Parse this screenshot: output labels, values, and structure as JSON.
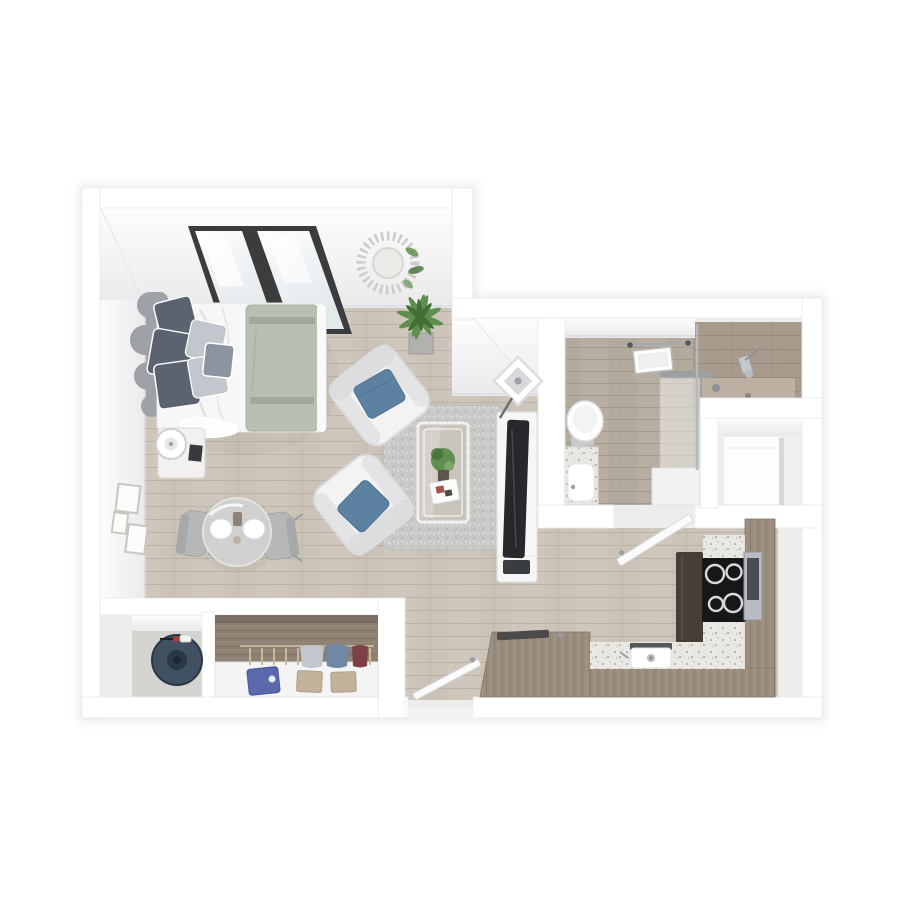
{
  "meta": {
    "title": "3D top-down floor plan render of a studio apartment",
    "view": "isometric top-down 3D floor plan",
    "background": "#ffffff",
    "visible_text": ""
  },
  "colors": {
    "wall": "#ffffff",
    "wall_edge": "#e8e8ea",
    "face_light": "#fbfbfc",
    "face_shade": "#ebebed",
    "baseboard": "#d9d9db",
    "shadow": "#dfdfe1",
    "floor_wood": "#cbc3b7",
    "floor_wood_line": "#bab2a5",
    "floor_bath": "#b3aa9e",
    "tile_shower": "#a89b8d",
    "counter_speckle": "#eae8e2",
    "cabinet_wood": "#9c8e7e",
    "cabinet_dark": "#897c6d",
    "fridge": "#463f37",
    "cooktop": "#171717",
    "burner_ring": "#d9d9d9",
    "stainless": "#b9bcc0",
    "heater_body": "#415062",
    "heater_dark": "#2a3745",
    "closet_wood": "#8d8173",
    "closet_floor": "#d6d4d1",
    "sheet": "#f7f7f8",
    "duvet": "#b8bfb3",
    "headboard": "#9ea1a6",
    "pillow_dark": "#5b6270",
    "pillow_mid": "#8e949f",
    "pillow_light": "#c3c7cd",
    "pillow_blue": "#5d81a0",
    "armchair": "#f3f3f4",
    "armchair_shade": "#dddde0",
    "rug": "#c9c9c7",
    "dining_chair": "#b5b7b8",
    "glass": "#d4d7d6",
    "plant": "#5f8f4e",
    "plant_dark": "#426f36",
    "pot": "#b3b1ad",
    "tv": "#26282b",
    "console": "#f6f6f7",
    "door": "#fbfbfc",
    "chrome": "#9ba0a5",
    "frame_art": "#fcfcfa",
    "window_frame": "#3c3c3e",
    "window_glass": "#eff3f4",
    "clothes_blue": "#5a68ae",
    "clothes_tan": "#c2b29b",
    "clothes_denim": "#7188a5",
    "clothes_red": "#7d4046",
    "appliance": "#fdfdfe",
    "toilet": "#fefefe",
    "sink": "#ffffff",
    "niche": "#f0f0f1"
  },
  "rooms": [
    {
      "id": "bedroom-living",
      "contents": [
        "slanted-window",
        "starburst-mirror",
        "bed-with-headboard",
        "gray-and-blue-pillows",
        "sage-duvet",
        "nightstand-with-lamp",
        "wall-art-frames",
        "round-glass-dining-table",
        "two-dining-chairs",
        "potted-plant",
        "two-white-armchairs",
        "speckled-area-rug",
        "glass-coffee-table",
        "tv-console-with-tv",
        "square-shade-floor-lamp"
      ]
    },
    {
      "id": "bathroom",
      "contents": [
        "toilet",
        "vanity-with-sink",
        "walk-in-tiled-shower",
        "glass-shower-panel",
        "shower-head",
        "ceiling-vent",
        "towel-bar",
        "swinging-door"
      ]
    },
    {
      "id": "appliance-closet",
      "contents": [
        "white-appliance-unit"
      ]
    },
    {
      "id": "kitchen",
      "contents": [
        "dark-refrigerator",
        "black-cooktop-four-burners",
        "stainless-wall-oven",
        "tall-wood-cabinets",
        "speckled-l-counter",
        "sink-with-drain",
        "wood-peninsula-counter",
        "entry-door"
      ]
    },
    {
      "id": "water-heater-closet",
      "contents": [
        "navy-water-heater-cylinder"
      ]
    },
    {
      "id": "wardrobe-closet",
      "contents": [
        "hanging-rod",
        "hanging-clothes",
        "folded-clothes-stacks",
        "white-shelf"
      ]
    }
  ]
}
